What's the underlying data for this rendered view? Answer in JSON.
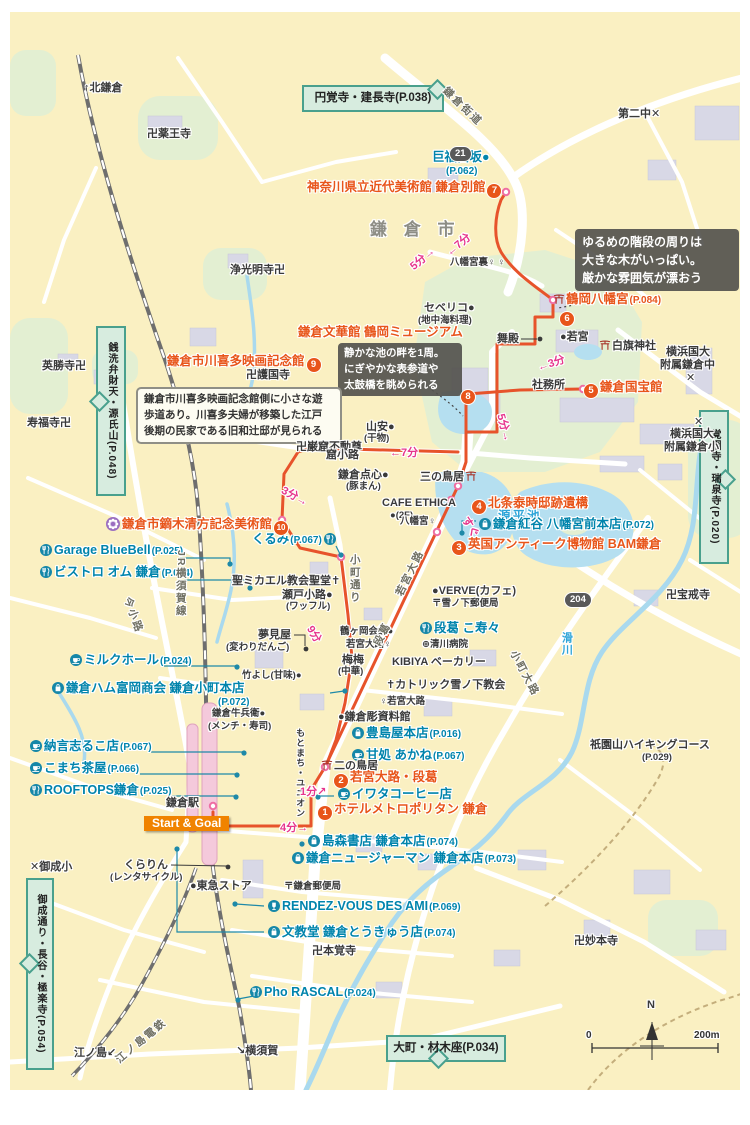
{
  "colors": {
    "map_bg": "#FAF0C2",
    "route_orange": "#E7532B",
    "poi_orange": "#E8551A",
    "shop_teal": "#0084AC",
    "time_pink": "#E6358C",
    "sign_green_bg": "#D7ECDF",
    "sign_green_border": "#49A08D",
    "water_blue": "#B5DFF0",
    "green_area": "#E3EFD2",
    "icon_teal": "#1587A8",
    "flower_purple": "#9B6FC0"
  },
  "map": {
    "signs": [
      {
        "n": "sign-engakuji-kenchoji",
        "t": "円覚寺・建長寺(P.038)",
        "x": 302,
        "y": 85,
        "w": 134,
        "h": 21,
        "v": false,
        "pt": "ne"
      },
      {
        "n": "sign-kakuonji-zuisenji",
        "t": "覚園寺・瑞泉寺(P.020)",
        "x": 699,
        "y": 410,
        "w": 24,
        "h": 142,
        "v": true,
        "pt": "right"
      },
      {
        "n": "sign-zeniarai-genjiyama",
        "t": "銭洗弁財天・源氏山(P.048)",
        "x": 96,
        "y": 326,
        "w": 24,
        "h": 158,
        "v": true,
        "pt": "left"
      },
      {
        "n": "sign-onari-hase-gokurakuji",
        "t": "御成通り・長谷・極楽寺(P.054)",
        "x": 26,
        "y": 878,
        "w": 22,
        "h": 180,
        "v": true,
        "pt": "left"
      },
      {
        "n": "sign-omachi-zaimokuza",
        "t": "大町・材木座(P.034)",
        "x": 386,
        "y": 1035,
        "w": 112,
        "h": 21,
        "v": false,
        "pt": "down"
      }
    ],
    "callouts": [
      {
        "n": "callout-hachimangu-stairs",
        "theme": "co-dark",
        "x": 575,
        "y": 229,
        "w": 150,
        "lines": [
          "ゆるめの階段の周りは",
          "大きな木がいっぱい。",
          "厳かな雰囲気が漂おう"
        ]
      },
      {
        "n": "callout-pond",
        "theme": "co-dark2",
        "x": 338,
        "y": 343,
        "w": 112,
        "lines": [
          "静かな池の畔を1周。",
          "にぎやかな表参道や",
          "太鼓橋を眺められる"
        ]
      },
      {
        "n": "callout-kawakita",
        "theme": "co-light",
        "x": 136,
        "y": 387,
        "w": 190,
        "lines": [
          "鎌倉市川喜多映画記念館側に小さな遊",
          "歩道あり。川喜多夫婦が移築した江戸",
          "後期の民家である旧和辻邸が見られる"
        ]
      }
    ],
    "labels": [
      {
        "n": "dir-kitakamakura",
        "t": "↑北鎌倉",
        "x": 84,
        "y": 82,
        "c": "feat"
      },
      {
        "n": "temple-yakuoji",
        "t": "卍薬王寺",
        "x": 147,
        "y": 128,
        "c": "feat"
      },
      {
        "n": "school-dainichu",
        "t": "第二中✕",
        "x": 618,
        "y": 108,
        "c": "feat"
      },
      {
        "n": "road-kamakura-kaido",
        "t": "鎌倉街道",
        "x": 444,
        "y": 84,
        "c": "road",
        "r": 44
      },
      {
        "n": "area-kamakura-shi",
        "t": "鎌 倉 市",
        "x": 370,
        "y": 220,
        "c": "big"
      },
      {
        "n": "spot-kobukurozaka",
        "t": "巨福呂坂●",
        "x": 432,
        "y": 150,
        "c": "shop"
      },
      {
        "n": "spot-kobukurozaka-page",
        "t": "(P.062)",
        "x": 446,
        "y": 166,
        "c": "pagel"
      },
      {
        "n": "poi-kindai-bijutsukan-annex",
        "t": "神奈川県立近代美術館 鎌倉別館",
        "x": 307,
        "y": 180,
        "c": "poi",
        "b": "7",
        "bp": "end"
      },
      {
        "n": "temple-jokomyoji",
        "t": "浄光明寺卍",
        "x": 230,
        "y": 264,
        "c": "feat"
      },
      {
        "n": "bus-hachimangu-ura",
        "t": "八幡宮裏♀ ♀",
        "x": 450,
        "y": 258,
        "c": "feat-s"
      },
      {
        "n": "shop-severico",
        "t": "セベリコ●",
        "x": 424,
        "y": 302,
        "c": "feat"
      },
      {
        "n": "shop-severico-sub",
        "t": "(地中海料理)",
        "x": 418,
        "y": 316,
        "c": "feat-s"
      },
      {
        "n": "poi-tsurugaoka-hachimangu",
        "t": "鶴岡八幡宮",
        "x": 552,
        "y": 292,
        "c": "poi",
        "i": "torii",
        "p": "(P.084)"
      },
      {
        "n": "poi-badge-6",
        "t": "",
        "x": 558,
        "y": 308,
        "c": "poi",
        "b": "6"
      },
      {
        "n": "poi-bunkakan-tsurugaoka-museum",
        "t": "鎌倉文華館 鶴岡ミュージアム",
        "x": 298,
        "y": 325,
        "c": "poi"
      },
      {
        "n": "poi-badge-8",
        "t": "",
        "x": 459,
        "y": 386,
        "c": "poi",
        "b": "8"
      },
      {
        "n": "poi-kawakita-film-museum",
        "t": "鎌倉市川喜多映画記念館",
        "x": 167,
        "y": 354,
        "c": "poi",
        "b": "9",
        "bp": "end"
      },
      {
        "n": "shrine-maiden",
        "t": "舞殿",
        "x": 497,
        "y": 333,
        "c": "feat"
      },
      {
        "n": "shrine-wakamiya",
        "t": "●若宮",
        "x": 560,
        "y": 331,
        "c": "feat"
      },
      {
        "n": "shrine-shirahata",
        "t": "白旗神社",
        "x": 598,
        "y": 339,
        "c": "feat",
        "i": "torii"
      },
      {
        "n": "school-yokohama-chu-1",
        "t": "横浜国大",
        "x": 666,
        "y": 346,
        "c": "feat"
      },
      {
        "n": "school-yokohama-chu-2",
        "t": "附属鎌倉中",
        "x": 660,
        "y": 359,
        "c": "feat"
      },
      {
        "n": "school-yokohama-chu-3",
        "t": "✕",
        "x": 686,
        "y": 372,
        "c": "feat"
      },
      {
        "n": "shrine-shamusho",
        "t": "社務所",
        "x": 532,
        "y": 379,
        "c": "feat"
      },
      {
        "n": "poi-kokuhokan",
        "t": "鎌倉国宝館",
        "x": 582,
        "y": 380,
        "c": "poi",
        "b": "5"
      },
      {
        "n": "temple-eishoji",
        "t": "英勝寺卍",
        "x": 42,
        "y": 360,
        "c": "feat"
      },
      {
        "n": "temple-gokokuji",
        "t": "卍護国寺",
        "x": 246,
        "y": 369,
        "c": "feat"
      },
      {
        "n": "temple-jufukuji",
        "t": "寿福寺卍",
        "x": 27,
        "y": 417,
        "c": "feat"
      },
      {
        "n": "shop-yamayasu",
        "t": "山安●",
        "x": 366,
        "y": 421,
        "c": "feat"
      },
      {
        "n": "shop-yamayasu-sub",
        "t": "(干物)",
        "x": 364,
        "y": 434,
        "c": "feat-s"
      },
      {
        "n": "water-genpeiike",
        "t": "源平池",
        "x": 498,
        "y": 509,
        "c": "water"
      },
      {
        "n": "school-yokohama-sho-x",
        "t": "✕",
        "x": 694,
        "y": 416,
        "c": "feat"
      },
      {
        "n": "school-yokohama-sho-1",
        "t": "横浜国大",
        "x": 670,
        "y": 428,
        "c": "feat"
      },
      {
        "n": "school-yokohama-sho-2",
        "t": "附属鎌倉小",
        "x": 664,
        "y": 441,
        "c": "feat"
      },
      {
        "n": "temple-gankutsu-fudoson",
        "t": "卍巌窟不動尊",
        "x": 296,
        "y": 441,
        "c": "feat"
      },
      {
        "n": "road-kutsukoji",
        "t": "窟小路",
        "x": 326,
        "y": 449,
        "c": "feat"
      },
      {
        "n": "shop-kamakura-tenshin",
        "t": "鎌倉点心●",
        "x": 338,
        "y": 469,
        "c": "feat"
      },
      {
        "n": "shop-kamakura-tenshin-sub",
        "t": "(豚まん)",
        "x": 346,
        "y": 482,
        "c": "feat-s"
      },
      {
        "n": "torii-sannotorii",
        "t": "三の鳥居",
        "x": 420,
        "y": 470,
        "c": "feat",
        "i": "torii",
        "ip": "end"
      },
      {
        "n": "shop-cafe-ethica",
        "t": "CAFE ETHICA",
        "x": 382,
        "y": 497,
        "c": "feat"
      },
      {
        "n": "shop-cafe-ethica-sub",
        "t": "●(2F)",
        "x": 390,
        "y": 511,
        "c": "feat-s"
      },
      {
        "n": "poi-hojo-yasutoki-ruins",
        "t": "北条泰時邸跡遺構",
        "x": 470,
        "y": 496,
        "c": "poi",
        "b": "4"
      },
      {
        "n": "bus-hachimangu",
        "t": "八幡宮♀",
        "x": 400,
        "y": 517,
        "c": "feat-s"
      },
      {
        "n": "shop-kurumi",
        "t": "くるみ",
        "x": 252,
        "y": 532,
        "c": "shop",
        "p": "(P.067)",
        "i": "fork",
        "ip": "end"
      },
      {
        "n": "shop-beniya-hachimangu",
        "t": "鎌倉紅谷 八幡宮前本店",
        "x": 477,
        "y": 517,
        "c": "shop",
        "p": "(P.072)",
        "i": "bag"
      },
      {
        "n": "poi-kaburaki-kiyokata-museum",
        "t": "鎌倉市鏑木清方記念美術館",
        "x": 104,
        "y": 517,
        "c": "poi",
        "b": "10",
        "bp": "end",
        "i": "flower"
      },
      {
        "n": "poi-bam-kamakura",
        "t": "英国アンティーク博物館 BAM鎌倉",
        "x": 450,
        "y": 537,
        "c": "poi",
        "b": "3"
      },
      {
        "n": "shop-garage-bluebell",
        "t": "Garage BlueBell",
        "x": 38,
        "y": 543,
        "c": "shop",
        "p": "(P.025)",
        "i": "fork"
      },
      {
        "n": "shop-bistro-om",
        "t": "ビストロ オム 鎌倉",
        "x": 38,
        "y": 565,
        "c": "shop",
        "p": "(P.024)",
        "i": "fork"
      },
      {
        "n": "church-st-michael",
        "t": "聖ミカエル教会聖堂✝",
        "x": 232,
        "y": 575,
        "c": "feat"
      },
      {
        "n": "shop-seto-koji",
        "t": "瀬戸小路●",
        "x": 282,
        "y": 589,
        "c": "feat"
      },
      {
        "n": "shop-seto-koji-sub",
        "t": "(ワッフル)",
        "x": 286,
        "y": 602,
        "c": "feat-s"
      },
      {
        "n": "shop-verve",
        "t": "●VERVE(カフェ)",
        "x": 432,
        "y": 585,
        "c": "feat"
      },
      {
        "n": "po-yukinoshita",
        "t": "〒雪ノ下郵便局",
        "x": 432,
        "y": 599,
        "c": "feat-s"
      },
      {
        "n": "temple-hokaiji",
        "t": "卍宝戒寺",
        "x": 666,
        "y": 589,
        "c": "feat"
      },
      {
        "n": "road-komachi-dori",
        "t": "小町通り",
        "x": 348,
        "y": 554,
        "c": "road-v"
      },
      {
        "n": "road-jr-yokosuka-line",
        "t": "JR横須賀線",
        "x": 174,
        "y": 550,
        "c": "road-v"
      },
      {
        "n": "road-imakoji",
        "t": "今小路",
        "x": 126,
        "y": 592,
        "c": "road",
        "r": 70
      },
      {
        "n": "shop-yumemiya",
        "t": "夢見屋",
        "x": 258,
        "y": 629,
        "c": "feat"
      },
      {
        "n": "shop-yumemiya-sub",
        "t": "(変わりだんご)",
        "x": 226,
        "y": 643,
        "c": "feat-s"
      },
      {
        "n": "shop-dankazura-kosuzu",
        "t": "段葛 こ寿々",
        "x": 418,
        "y": 621,
        "c": "shop",
        "i": "fork"
      },
      {
        "n": "hospital-kiyokawa",
        "t": "⊕清川病院",
        "x": 422,
        "y": 640,
        "c": "feat-s"
      },
      {
        "n": "shop-kibiya-bakery",
        "t": "KIBIYA ベーカリー",
        "x": 392,
        "y": 656,
        "c": "feat"
      },
      {
        "n": "spot-tsurugaoka-kaikan",
        "t": "鶴ヶ岡会館●",
        "x": 340,
        "y": 627,
        "c": "feat-s"
      },
      {
        "n": "bus-wakamiya-oji",
        "t": "若宮大路♀",
        "x": 346,
        "y": 640,
        "c": "feat-s"
      },
      {
        "n": "shop-maimai",
        "t": "梅梅",
        "x": 342,
        "y": 654,
        "c": "feat"
      },
      {
        "n": "shop-maimai-sub",
        "t": "(中華)",
        "x": 338,
        "y": 667,
        "c": "feat-s"
      },
      {
        "n": "shop-takeyoshi",
        "t": "竹よし(甘味)●",
        "x": 242,
        "y": 671,
        "c": "feat-s"
      },
      {
        "n": "shop-milk-hall",
        "t": "ミルクホール",
        "x": 68,
        "y": 653,
        "c": "shop",
        "p": "(P.024)",
        "i": "cup"
      },
      {
        "n": "shop-kamakura-ham",
        "t": "鎌倉ハム富岡商会 鎌倉小町本店",
        "x": 50,
        "y": 681,
        "c": "shop",
        "i": "bag"
      },
      {
        "n": "shop-kamakura-ham-page",
        "t": "(P.072)",
        "x": 218,
        "y": 697,
        "c": "pagel"
      },
      {
        "n": "church-catholic-yukinoshita",
        "t": "✝カトリック雪ノ下教会",
        "x": 386,
        "y": 679,
        "c": "feat"
      },
      {
        "n": "bus-wakamiya-oji-2",
        "t": "♀若宮大路",
        "x": 380,
        "y": 697,
        "c": "feat-s"
      },
      {
        "n": "spot-kamakurabori-museum",
        "t": "●鎌倉彫資料館",
        "x": 338,
        "y": 711,
        "c": "feat"
      },
      {
        "n": "shop-toshimaya",
        "t": "豊島屋本店",
        "x": 350,
        "y": 726,
        "c": "shop",
        "p": "(P.016)",
        "i": "bag"
      },
      {
        "n": "shop-amadokoro-akane",
        "t": "甘処 あかね",
        "x": 350,
        "y": 748,
        "c": "shop",
        "p": "(P.067)",
        "i": "cup"
      },
      {
        "n": "shop-gyube",
        "t": "鎌倉牛兵衛●",
        "x": 212,
        "y": 709,
        "c": "feat-s"
      },
      {
        "n": "shop-gyube-sub",
        "t": "(メンチ・寿司)",
        "x": 208,
        "y": 722,
        "c": "feat-s"
      },
      {
        "n": "shop-motomachi-union",
        "t": "もとまち・ユニオン",
        "x": 295,
        "y": 728,
        "c": "feat-v"
      },
      {
        "n": "shop-nagon-shiruko",
        "t": "納言志るこ店",
        "x": 28,
        "y": 739,
        "c": "shop",
        "p": "(P.067)",
        "i": "cup"
      },
      {
        "n": "shop-komachi-chaya",
        "t": "こまち茶屋",
        "x": 28,
        "y": 761,
        "c": "shop",
        "p": "(P.066)",
        "i": "cup"
      },
      {
        "n": "shop-rooftops",
        "t": "ROOFTOPS鎌倉",
        "x": 28,
        "y": 783,
        "c": "shop",
        "p": "(P.025)",
        "i": "fork"
      },
      {
        "n": "torii-ninotorii",
        "t": "二の鳥居",
        "x": 320,
        "y": 759,
        "c": "feat",
        "i": "torii"
      },
      {
        "n": "poi-wakamiya-oji-dankazura",
        "t": "若宮大路・段葛",
        "x": 332,
        "y": 770,
        "c": "poi",
        "b": "2"
      },
      {
        "n": "shop-iwata-coffee",
        "t": "イワタコーヒー店",
        "x": 336,
        "y": 787,
        "c": "shop",
        "i": "cup"
      },
      {
        "n": "poi-hotel-metropolitan",
        "t": "ホテルメトロポリタン 鎌倉",
        "x": 316,
        "y": 802,
        "c": "poi",
        "b": "1"
      },
      {
        "n": "station-kamakura",
        "t": "鎌倉駅",
        "x": 166,
        "y": 797,
        "c": "feat"
      },
      {
        "n": "shop-shimamori-books",
        "t": "島森書店 鎌倉本店",
        "x": 306,
        "y": 834,
        "c": "shop",
        "p": "(P.074)",
        "i": "bag"
      },
      {
        "n": "shop-new-german",
        "t": "鎌倉ニュージャーマン 鎌倉本店",
        "x": 290,
        "y": 851,
        "c": "shop",
        "p": "(P.073)",
        "i": "bag"
      },
      {
        "n": "shop-kurarin",
        "t": "くらりん",
        "x": 124,
        "y": 859,
        "c": "feat"
      },
      {
        "n": "shop-kurarin-sub",
        "t": "(レンタサイクル)",
        "x": 110,
        "y": 873,
        "c": "feat-s"
      },
      {
        "n": "shop-tokyu-store",
        "t": "●東急ストア",
        "x": 190,
        "y": 880,
        "c": "feat"
      },
      {
        "n": "po-kamakura",
        "t": "〒鎌倉郵便局",
        "x": 284,
        "y": 882,
        "c": "feat-s"
      },
      {
        "n": "shop-rendez-vous-des-ami",
        "t": "RENDEZ-VOUS DES AMI",
        "x": 266,
        "y": 899,
        "c": "shop",
        "p": "(P.069)",
        "i": "glass"
      },
      {
        "n": "shop-bunkyodo",
        "t": "文教堂 鎌倉とうきゅう店",
        "x": 266,
        "y": 925,
        "c": "shop",
        "p": "(P.074)",
        "i": "bag"
      },
      {
        "n": "temple-honkakuji",
        "t": "卍本覚寺",
        "x": 312,
        "y": 945,
        "c": "feat"
      },
      {
        "n": "school-onari",
        "t": "✕御成小",
        "x": 30,
        "y": 861,
        "c": "feat"
      },
      {
        "n": "temple-myohonji",
        "t": "卍妙本寺",
        "x": 574,
        "y": 935,
        "c": "feat"
      },
      {
        "n": "shop-pho-rascal",
        "t": "Pho RASCAL",
        "x": 248,
        "y": 985,
        "c": "shop",
        "p": "(P.024)",
        "i": "fork"
      },
      {
        "n": "trail-gionyama",
        "t": "祇園山ハイキングコース",
        "x": 590,
        "y": 739,
        "c": "feat"
      },
      {
        "n": "trail-gionyama-page",
        "t": "(P.029)",
        "x": 642,
        "y": 753,
        "c": "feat-s"
      },
      {
        "n": "rail-enoden",
        "t": "江ノ島電鉄",
        "x": 118,
        "y": 1056,
        "c": "road",
        "r": -40
      },
      {
        "n": "dir-enoshima",
        "t": "江ノ島↙",
        "x": 74,
        "y": 1047,
        "c": "feat"
      },
      {
        "n": "dir-yokosuka",
        "t": "↘横須賀",
        "x": 236,
        "y": 1045,
        "c": "feat"
      },
      {
        "n": "road-komachi-oji",
        "t": "小町大路",
        "x": 512,
        "y": 646,
        "c": "road",
        "r": 62
      },
      {
        "n": "water-namerigawa",
        "t": "滑川",
        "x": 560,
        "y": 632,
        "c": "water-v"
      },
      {
        "n": "road-wakamiya-oji",
        "t": "若宮大路",
        "x": 400,
        "y": 590,
        "c": "road",
        "r": -64
      },
      {
        "n": "road-dankazura",
        "t": "段葛",
        "x": 378,
        "y": 640,
        "c": "road",
        "r": -64
      },
      {
        "n": "time-5min-upper",
        "t": "5分→",
        "x": 412,
        "y": 262,
        "c": "time",
        "r": -40
      },
      {
        "n": "time-7min-upper",
        "t": "←7分",
        "x": 448,
        "y": 248,
        "c": "time",
        "r": -40
      },
      {
        "n": "time-3min-kokuhokan",
        "t": "←3分",
        "x": 538,
        "y": 362,
        "c": "time",
        "r": -18
      },
      {
        "n": "time-5min-pond",
        "t": "5分→",
        "x": 500,
        "y": 408,
        "c": "time",
        "r": 75
      },
      {
        "n": "time-7min-kutsukoji",
        "t": "←7分",
        "x": 390,
        "y": 447,
        "c": "time"
      },
      {
        "n": "time-3min-museum",
        "t": "3分→",
        "x": 282,
        "y": 484,
        "c": "time",
        "r": 28
      },
      {
        "n": "time-9min-komachi",
        "t": "9分",
        "x": 309,
        "y": 621,
        "c": "time",
        "r": 58
      },
      {
        "n": "time-sugu",
        "t": "すぐ",
        "x": 464,
        "y": 512,
        "c": "time",
        "r": 58
      },
      {
        "n": "time-1min",
        "t": "1分↗",
        "x": 300,
        "y": 786,
        "c": "time"
      },
      {
        "n": "time-4min",
        "t": "4分→",
        "x": 280,
        "y": 822,
        "c": "time"
      },
      {
        "n": "route-badge-21",
        "t": "21",
        "x": 449,
        "y": 146,
        "c": "rbadge"
      },
      {
        "n": "route-badge-204",
        "t": "204",
        "x": 564,
        "y": 592,
        "c": "rbadge"
      },
      {
        "n": "start-goal-badge",
        "t": "Start & Goal",
        "x": 144,
        "y": 816,
        "c": "startgoal"
      },
      {
        "n": "compass-n-label",
        "t": "N",
        "x": 647,
        "y": 999,
        "c": "feat"
      },
      {
        "n": "scale-zero",
        "t": "0",
        "x": 586,
        "y": 1030,
        "c": "scalenum"
      },
      {
        "n": "scale-200m",
        "t": "200m",
        "x": 694,
        "y": 1030,
        "c": "scalenum"
      }
    ]
  }
}
